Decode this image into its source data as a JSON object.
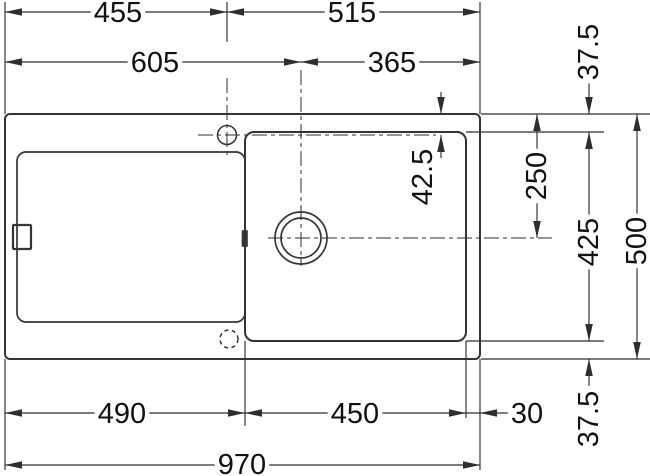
{
  "diagram": {
    "type": "technical-drawing",
    "canvas": {
      "width": 650,
      "height": 476
    },
    "colors": {
      "background": "#ffffff",
      "line": "#2e2e2e",
      "object_line": "#343434",
      "text": "#111111"
    },
    "dimension_labels": {
      "top_row": [
        "455",
        "515"
      ],
      "second_row": [
        "605",
        "365"
      ],
      "bottom_row": [
        "490",
        "450",
        "30"
      ],
      "overall_width": "970",
      "right_column": [
        "37.5",
        "250",
        "425",
        "500",
        "37.5"
      ],
      "faucet_offset": "42.5"
    },
    "shapes": {
      "rects": [
        {
          "name": "sink-outline",
          "x": 5,
          "y": 114,
          "w": 475,
          "h": 245,
          "r": 5,
          "sw": 2
        },
        {
          "name": "drainboard-outline",
          "x": 17,
          "y": 152,
          "w": 228,
          "h": 170,
          "r": 9,
          "sw": 1.7
        },
        {
          "name": "bowl-outline",
          "x": 245,
          "y": 132,
          "w": 221,
          "h": 209,
          "r": 9,
          "sw": 2
        },
        {
          "name": "overflow-detail",
          "x": 13,
          "y": 225,
          "w": 18,
          "h": 24,
          "r": 1,
          "sw": 2.2
        },
        {
          "name": "bowl-edge-notch",
          "x": 242.5,
          "y": 231,
          "w": 4.5,
          "h": 15,
          "r": 0,
          "fill": true
        }
      ],
      "circles": [
        {
          "name": "faucet-hole",
          "cx": 227,
          "cy": 135,
          "r": 9.5,
          "sw": 1.5
        },
        {
          "name": "drain-hole-outer",
          "cx": 301,
          "cy": 238,
          "r": 26,
          "sw": 1.7
        },
        {
          "name": "drain-hole-inner",
          "cx": 301,
          "cy": 238,
          "r": 20,
          "sw": 1.7
        },
        {
          "name": "optional-faucet-hole",
          "cx": 229,
          "cy": 339,
          "r": 9,
          "sw": 1.5,
          "dash": "4 3.5"
        }
      ],
      "lines": [
        [
          5,
          2,
          5,
          114
        ],
        [
          5,
          359,
          5,
          470
        ],
        [
          480,
          2,
          480,
          114
        ],
        [
          480,
          359,
          480,
          470
        ],
        [
          227,
          2,
          227,
          42
        ],
        [
          245,
          341,
          245,
          426
        ],
        [
          466,
          341,
          466,
          418
        ],
        [
          481,
          114,
          650,
          114
        ],
        [
          466,
          132,
          604,
          132
        ],
        [
          466,
          341,
          604,
          341
        ],
        [
          481,
          359,
          650,
          359
        ],
        [
          5,
          12,
          480,
          12
        ],
        [
          5,
          62,
          480,
          62
        ],
        [
          5,
          413,
          508,
          413
        ],
        [
          5,
          465,
          480,
          465
        ],
        [
          537,
          114,
          537,
          238
        ],
        [
          589,
          132,
          589,
          341
        ],
        [
          637,
          114,
          637,
          359
        ],
        [
          589,
          80,
          589,
          114
        ],
        [
          589,
          359,
          589,
          386
        ],
        [
          441,
          92,
          441,
          114
        ],
        [
          441,
          135,
          441,
          158
        ]
      ],
      "centerlines": [
        [
          227,
          78,
          227,
          156
        ],
        [
          198,
          135,
          436,
          135
        ],
        [
          301,
          70,
          301,
          266
        ],
        [
          268,
          238,
          552,
          238
        ]
      ],
      "arrows": [
        {
          "x": 5,
          "y": 12,
          "d": "l"
        },
        {
          "x": 227,
          "y": 12,
          "d": "r"
        },
        {
          "x": 227,
          "y": 12,
          "d": "l"
        },
        {
          "x": 480,
          "y": 12,
          "d": "r"
        },
        {
          "x": 5,
          "y": 62,
          "d": "l"
        },
        {
          "x": 301,
          "y": 62,
          "d": "r"
        },
        {
          "x": 301,
          "y": 62,
          "d": "l"
        },
        {
          "x": 480,
          "y": 62,
          "d": "r"
        },
        {
          "x": 5,
          "y": 413,
          "d": "l"
        },
        {
          "x": 245,
          "y": 413,
          "d": "r"
        },
        {
          "x": 245,
          "y": 413,
          "d": "l"
        },
        {
          "x": 466,
          "y": 413,
          "d": "r"
        },
        {
          "x": 480,
          "y": 413,
          "d": "l"
        },
        {
          "x": 5,
          "y": 465,
          "d": "l"
        },
        {
          "x": 480,
          "y": 465,
          "d": "r"
        },
        {
          "x": 537,
          "y": 114,
          "d": "u"
        },
        {
          "x": 537,
          "y": 238,
          "d": "d"
        },
        {
          "x": 589,
          "y": 114,
          "d": "d"
        },
        {
          "x": 589,
          "y": 132,
          "d": "u"
        },
        {
          "x": 589,
          "y": 341,
          "d": "d"
        },
        {
          "x": 589,
          "y": 359,
          "d": "u"
        },
        {
          "x": 637,
          "y": 114,
          "d": "u"
        },
        {
          "x": 637,
          "y": 359,
          "d": "d"
        },
        {
          "x": 441,
          "y": 114,
          "d": "d"
        },
        {
          "x": 441,
          "y": 135,
          "d": "u"
        }
      ],
      "texts": [
        {
          "t": "455",
          "x": 118,
          "y": 13
        },
        {
          "t": "515",
          "x": 352,
          "y": 13
        },
        {
          "t": "605",
          "x": 155,
          "y": 63
        },
        {
          "t": "365",
          "x": 392,
          "y": 63
        },
        {
          "t": "490",
          "x": 122,
          "y": 414
        },
        {
          "t": "450",
          "x": 355,
          "y": 414
        },
        {
          "t": "30",
          "x": 527,
          "y": 414
        },
        {
          "t": "970",
          "x": 242,
          "y": 465
        },
        {
          "t": "37.5",
          "x": 589,
          "y": 52,
          "rot": true
        },
        {
          "t": "42.5",
          "x": 423,
          "y": 177,
          "rot": true
        },
        {
          "t": "250",
          "x": 537,
          "y": 176,
          "rot": true
        },
        {
          "t": "425",
          "x": 589,
          "y": 242,
          "rot": true
        },
        {
          "t": "500",
          "x": 637,
          "y": 241,
          "rot": true
        },
        {
          "t": "37.5",
          "x": 589,
          "y": 419,
          "rot": true
        }
      ]
    }
  }
}
